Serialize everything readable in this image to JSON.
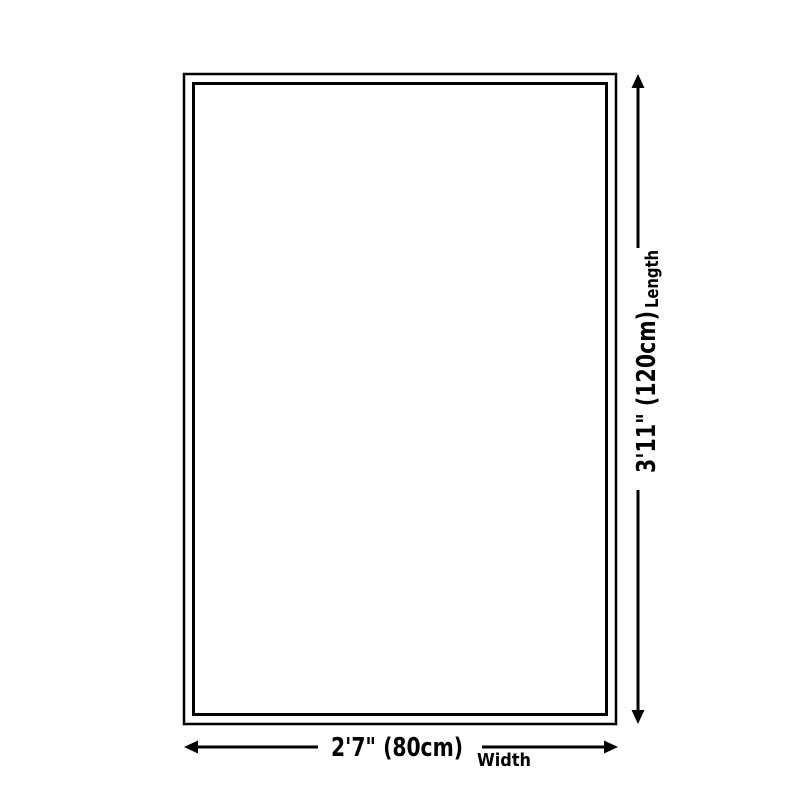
{
  "diagram": {
    "title": "rug-size-dimension-diagram",
    "width": {
      "value": "2'7\" (80cm)",
      "label": "Width"
    },
    "length": {
      "value": "3'11\" (120cm)",
      "label": "Length"
    },
    "colors": {
      "line": "#000000",
      "background": "#ffffff"
    }
  }
}
